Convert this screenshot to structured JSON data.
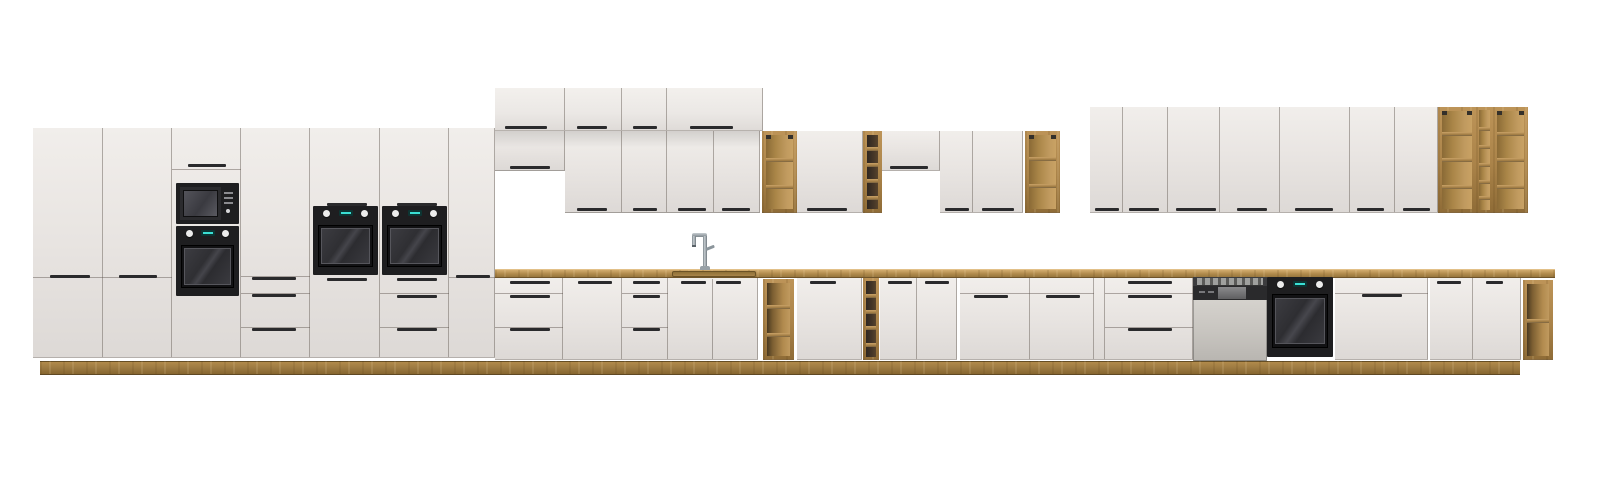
{
  "meta": {
    "title": "Modular kitchen furniture set product image",
    "width": 1600,
    "height": 482,
    "background": "#ffffff"
  },
  "colors": {
    "front_hi": "#f1eeeb",
    "front": "#e8e4e1",
    "front_lo": "#ddd9d6",
    "gap_line": "rgba(110,102,95,0.5)",
    "divider": "rgba(90,82,75,0.45)",
    "handle": "#2a2a2c",
    "wood_light": "#bd9458",
    "wood": "#aa8349",
    "wood_dark": "#8f6c37",
    "counter_hi": "#d2ac6e",
    "counter_lo": "#97763e",
    "plinth_edge": "#5f4823",
    "appliance_black": "#1e1e20",
    "oven_window": "#3c3c41",
    "knob_white": "#ececec",
    "display_teal": "#3adfd4",
    "steel_body": "#c9c6c1",
    "chrome": "#8b959b",
    "chrome_hi": "#c6cdd1"
  },
  "modules": [
    {
      "name": "plinth",
      "kind": "plinth",
      "r": [
        40,
        361,
        1480,
        14
      ]
    },
    {
      "name": "countertop",
      "kind": "counter",
      "r": [
        495,
        269,
        1060,
        9
      ]
    },
    {
      "name": "sink-basin",
      "kind": "sink",
      "r": [
        672,
        271,
        84,
        6
      ]
    },
    {
      "name": "tall-cabinet-door",
      "kind": "front",
      "r": [
        33,
        128,
        70,
        230
      ],
      "hlines": [
        277
      ],
      "handles": [
        [
          50,
          275,
          40
        ]
      ]
    },
    {
      "name": "tall-cabinet-door",
      "kind": "front",
      "r": [
        103,
        128,
        69,
        230
      ],
      "hlines": [
        277
      ],
      "handles": [
        [
          119,
          275,
          38
        ]
      ]
    },
    {
      "name": "tall-oven-microwave-column",
      "kind": "front",
      "r": [
        172,
        128,
        69,
        230
      ],
      "hlines": [
        169
      ],
      "handles": [
        [
          188,
          164,
          38
        ]
      ]
    },
    {
      "name": "tall-cabinet-drawer-column",
      "kind": "front",
      "r": [
        241,
        128,
        69,
        230
      ],
      "hlines": [
        276,
        293,
        327
      ],
      "handles": [
        [
          252,
          277,
          44
        ],
        [
          252,
          294,
          44
        ],
        [
          252,
          328,
          44
        ]
      ]
    },
    {
      "name": "tall-oven-column",
      "kind": "front",
      "r": [
        310,
        128,
        70,
        230
      ],
      "handles": [
        [
          327,
          203,
          40
        ],
        [
          327,
          278,
          40
        ]
      ]
    },
    {
      "name": "tall-oven-drawer-column",
      "kind": "front",
      "r": [
        380,
        128,
        69,
        230
      ],
      "hlines": [
        293,
        327
      ],
      "handles": [
        [
          397,
          203,
          40
        ],
        [
          397,
          278,
          40
        ],
        [
          397,
          295,
          40
        ],
        [
          397,
          328,
          40
        ]
      ]
    },
    {
      "name": "tall-cabinet-door",
      "kind": "front",
      "r": [
        449,
        128,
        46,
        230
      ],
      "hlines": [
        277
      ],
      "handles": [
        [
          456,
          275,
          34
        ]
      ]
    },
    {
      "name": "top-wall-cabinet",
      "kind": "front",
      "top": true,
      "r": [
        495,
        88,
        70,
        43
      ],
      "handles": [
        [
          505,
          126,
          42
        ]
      ]
    },
    {
      "name": "top-wall-cabinet",
      "kind": "front",
      "top": true,
      "r": [
        565,
        88,
        57,
        43
      ],
      "handles": [
        [
          577,
          126,
          30
        ]
      ]
    },
    {
      "name": "top-wall-cabinet",
      "kind": "front",
      "top": true,
      "r": [
        622,
        88,
        45,
        43
      ],
      "handles": [
        [
          633,
          126,
          24
        ]
      ]
    },
    {
      "name": "top-wall-cabinet",
      "kind": "front",
      "top": true,
      "r": [
        667,
        88,
        96,
        43
      ],
      "handles": [
        [
          690,
          126,
          43
        ]
      ]
    },
    {
      "name": "wall-cabinet-short",
      "kind": "front",
      "shade": true,
      "r": [
        495,
        131,
        70,
        40
      ],
      "handles": [
        [
          510,
          166,
          40
        ]
      ]
    },
    {
      "name": "wall-cabinet",
      "kind": "front",
      "shade": true,
      "r": [
        565,
        131,
        57,
        82
      ],
      "handles": [
        [
          577,
          208,
          30
        ]
      ]
    },
    {
      "name": "wall-cabinet",
      "kind": "front",
      "shade": true,
      "r": [
        622,
        131,
        45,
        82
      ],
      "handles": [
        [
          633,
          208,
          24
        ]
      ]
    },
    {
      "name": "wall-cabinet",
      "kind": "front",
      "shade": true,
      "r": [
        667,
        131,
        47,
        82
      ],
      "handles": [
        [
          678,
          208,
          28
        ]
      ]
    },
    {
      "name": "wall-cabinet",
      "kind": "front",
      "shade": true,
      "r": [
        714,
        131,
        46,
        82
      ],
      "handles": [
        [
          722,
          208,
          28
        ]
      ]
    },
    {
      "name": "open-shelf-wall-unit",
      "kind": "shelf",
      "r": [
        762,
        131,
        35,
        82
      ],
      "shelves": [
        158,
        185
      ],
      "br": true
    },
    {
      "name": "wall-cabinet",
      "kind": "front",
      "r": [
        797,
        131,
        66,
        82
      ],
      "handles": [
        [
          807,
          208,
          40
        ]
      ]
    },
    {
      "name": "wine-rack-wall-unit",
      "kind": "shelf",
      "r": [
        863,
        131,
        19,
        82
      ],
      "shelves": [
        147,
        163,
        179,
        196
      ],
      "dark": true
    },
    {
      "name": "wall-cabinet-short",
      "kind": "front",
      "r": [
        882,
        131,
        58,
        40
      ],
      "handles": [
        [
          890,
          166,
          38
        ]
      ]
    },
    {
      "name": "wall-cabinet",
      "kind": "front",
      "r": [
        940,
        131,
        33,
        82
      ],
      "handles": [
        [
          945,
          208,
          24
        ]
      ]
    },
    {
      "name": "wall-cabinet",
      "kind": "front",
      "r": [
        973,
        131,
        50,
        82
      ],
      "handles": [
        [
          982,
          208,
          32
        ]
      ]
    },
    {
      "name": "open-shelf-wall-unit",
      "kind": "shelf",
      "r": [
        1025,
        131,
        35,
        82
      ],
      "shelves": [
        157,
        184
      ],
      "br": true
    },
    {
      "name": "wall-cabinet-tall",
      "kind": "front",
      "r": [
        1090,
        107,
        33,
        106
      ],
      "handles": [
        [
          1095,
          208,
          24
        ]
      ]
    },
    {
      "name": "wall-cabinet-tall",
      "kind": "front",
      "r": [
        1123,
        107,
        45,
        106
      ],
      "handles": [
        [
          1129,
          208,
          30
        ]
      ]
    },
    {
      "name": "wall-cabinet-tall",
      "kind": "front",
      "r": [
        1168,
        107,
        52,
        106
      ],
      "handles": [
        [
          1176,
          208,
          40
        ]
      ]
    },
    {
      "name": "wall-cabinet-tall",
      "kind": "front",
      "r": [
        1220,
        107,
        60,
        106
      ],
      "handles": [
        [
          1237,
          208,
          30
        ]
      ]
    },
    {
      "name": "wall-cabinet-tall",
      "kind": "front",
      "r": [
        1280,
        107,
        70,
        106
      ],
      "handles": [
        [
          1295,
          208,
          38
        ]
      ]
    },
    {
      "name": "wall-cabinet-tall",
      "kind": "front",
      "r": [
        1350,
        107,
        45,
        106
      ],
      "handles": [
        [
          1357,
          208,
          27
        ]
      ]
    },
    {
      "name": "wall-cabinet-tall",
      "kind": "front",
      "r": [
        1395,
        107,
        43,
        106
      ],
      "handles": [
        [
          1403,
          208,
          27
        ]
      ]
    },
    {
      "name": "open-shelf-tall-unit",
      "kind": "shelf",
      "r": [
        1438,
        107,
        38,
        106
      ],
      "shelves": [
        132,
        158,
        185
      ],
      "br": true
    },
    {
      "name": "wine-shelf-column",
      "kind": "shelf",
      "r": [
        1476,
        107,
        17,
        106
      ],
      "shelves": [
        127,
        145,
        163,
        180,
        196
      ],
      "t": 3
    },
    {
      "name": "open-shelf-tall-unit",
      "kind": "shelf",
      "r": [
        1493,
        107,
        35,
        106
      ],
      "shelves": [
        132,
        158,
        185
      ],
      "br": true
    },
    {
      "name": "base-drawer-unit",
      "kind": "front",
      "r": [
        495,
        278,
        68,
        82
      ],
      "hlines": [
        293,
        327
      ],
      "handles": [
        [
          510,
          281,
          40
        ],
        [
          510,
          295,
          40
        ],
        [
          510,
          328,
          40
        ]
      ]
    },
    {
      "name": "base-cabinet",
      "kind": "front",
      "r": [
        563,
        278,
        59,
        82
      ],
      "handles": [
        [
          578,
          281,
          34
        ]
      ]
    },
    {
      "name": "base-drawer-unit",
      "kind": "front",
      "r": [
        622,
        278,
        46,
        82
      ],
      "hlines": [
        293,
        327
      ],
      "handles": [
        [
          633,
          281,
          27
        ],
        [
          633,
          295,
          27
        ],
        [
          633,
          328,
          27
        ]
      ]
    },
    {
      "name": "sink-base-cabinet",
      "kind": "front",
      "r": [
        668,
        278,
        90,
        82
      ],
      "vlines": [
        712
      ],
      "handles": [
        [
          681,
          281,
          25
        ],
        [
          716,
          281,
          25
        ]
      ]
    },
    {
      "name": "open-shelf-base-unit",
      "kind": "shelf",
      "r": [
        763,
        279,
        31,
        81
      ],
      "shelves": [
        305,
        333
      ],
      "darkleft": true
    },
    {
      "name": "base-cabinet",
      "kind": "front",
      "r": [
        797,
        278,
        65,
        82
      ],
      "handles": [
        [
          810,
          281,
          26
        ]
      ]
    },
    {
      "name": "wine-rack-base-unit",
      "kind": "shelf",
      "r": [
        863,
        278,
        16,
        82
      ],
      "shelves": [
        294,
        310,
        326,
        343
      ],
      "dark": true,
      "t": 3
    },
    {
      "name": "base-cabinet",
      "kind": "front",
      "r": [
        880,
        278,
        37,
        82
      ],
      "handles": [
        [
          888,
          281,
          24
        ]
      ]
    },
    {
      "name": "base-cabinet",
      "kind": "front",
      "r": [
        917,
        278,
        40,
        82
      ],
      "handles": [
        [
          925,
          281,
          24
        ]
      ]
    },
    {
      "name": "appliance-front-cabinet",
      "kind": "front",
      "r": [
        960,
        278,
        70,
        82
      ],
      "hlines": [
        293
      ],
      "handles": [
        [
          974,
          295,
          34
        ]
      ]
    },
    {
      "name": "appliance-front-cabinet",
      "kind": "front",
      "r": [
        1030,
        278,
        64,
        82
      ],
      "hlines": [
        293
      ],
      "handles": [
        [
          1046,
          295,
          34
        ]
      ]
    },
    {
      "name": "filler-panel",
      "kind": "front",
      "r": [
        1094,
        278,
        11,
        82
      ]
    },
    {
      "name": "base-drawer-unit-wide",
      "kind": "front",
      "r": [
        1105,
        278,
        88,
        82
      ],
      "hlines": [
        293,
        327
      ],
      "handles": [
        [
          1128,
          281,
          44
        ],
        [
          1128,
          295,
          44
        ],
        [
          1128,
          328,
          44
        ]
      ]
    },
    {
      "name": "appliance-front-cabinet-wide",
      "kind": "front",
      "r": [
        1335,
        278,
        93,
        82
      ],
      "hlines": [
        293
      ],
      "handles": [
        [
          1362,
          294,
          40
        ]
      ]
    },
    {
      "name": "base-cabinet",
      "kind": "front",
      "r": [
        1430,
        278,
        43,
        82
      ],
      "handles": [
        [
          1437,
          281,
          24
        ]
      ]
    },
    {
      "name": "base-cabinet",
      "kind": "front",
      "r": [
        1473,
        278,
        48,
        82
      ],
      "handles": [
        [
          1486,
          281,
          17
        ]
      ]
    },
    {
      "name": "open-shelf-base-end-unit",
      "kind": "shelf",
      "r": [
        1523,
        280,
        30,
        80
      ],
      "shelves": [
        319
      ],
      "darkleft": true
    },
    {
      "name": "built-in-microwave",
      "kind": "microwave",
      "r": [
        176,
        183,
        63,
        41
      ]
    },
    {
      "name": "built-in-oven",
      "kind": "oven",
      "r": [
        176,
        226,
        63,
        70
      ]
    },
    {
      "name": "built-in-oven",
      "kind": "oven",
      "r": [
        313,
        206,
        65,
        69
      ]
    },
    {
      "name": "built-in-oven",
      "kind": "oven",
      "r": [
        382,
        206,
        65,
        69
      ]
    },
    {
      "name": "built-in-dishwasher",
      "kind": "dishwasher",
      "r": [
        1193,
        277,
        74,
        84
      ]
    },
    {
      "name": "built-in-oven-base",
      "kind": "oven-base",
      "r": [
        1267,
        277,
        66,
        80
      ]
    },
    {
      "name": "sink-faucet",
      "kind": "faucet",
      "r": [
        692,
        233,
        24,
        37
      ]
    }
  ]
}
